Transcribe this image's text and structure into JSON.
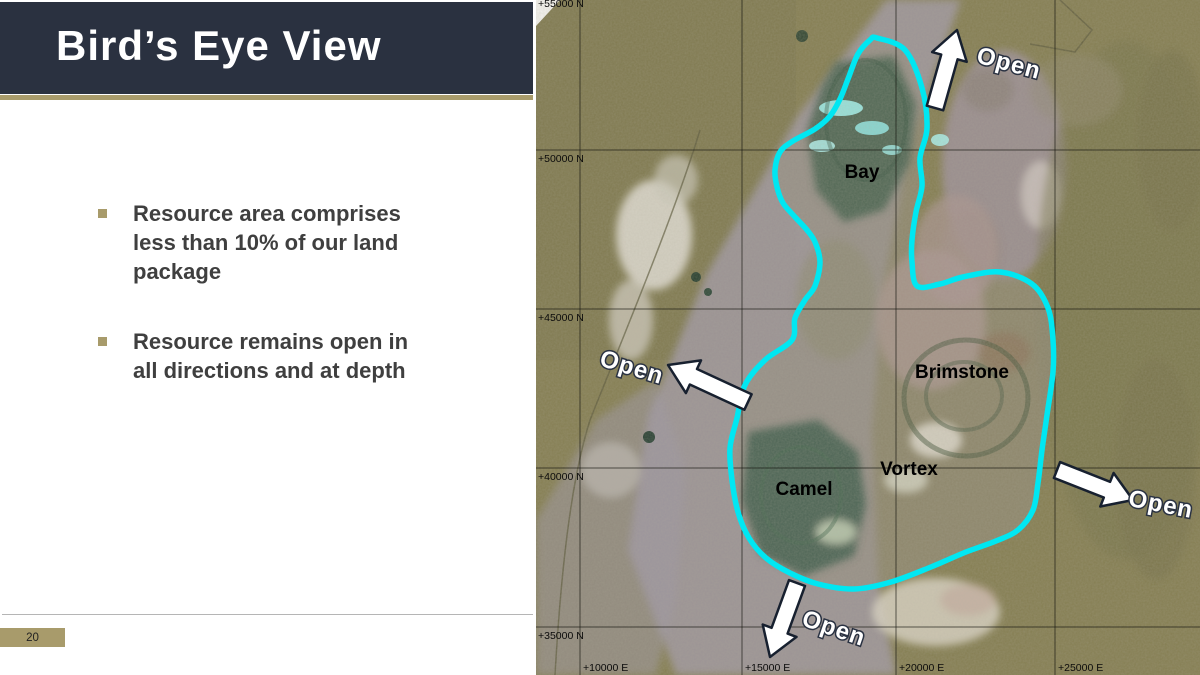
{
  "theme": {
    "navy": "#2a3140",
    "tan": "#a89b6b",
    "bodytext": "#3f3f3f",
    "cyan": "#00e7f2"
  },
  "slide": {
    "title": "Bird’s Eye View",
    "bullets": [
      "Resource area comprises\nless than 10% of our land\npackage",
      "Resource remains open in\nall directions and at depth"
    ],
    "page_number": "20"
  },
  "map": {
    "grid": {
      "vlines": [
        44,
        206,
        360,
        519
      ],
      "hlines": [
        150,
        309,
        468,
        627
      ],
      "n_labels": [
        {
          "text": "+55000 N",
          "x": 2,
          "y": 7
        },
        {
          "text": "+50000 N",
          "x": 2,
          "y": 162
        },
        {
          "text": "+45000 N",
          "x": 2,
          "y": 321
        },
        {
          "text": "+40000 N",
          "x": 2,
          "y": 480
        },
        {
          "text": "+35000 N",
          "x": 2,
          "y": 639
        }
      ],
      "e_labels": [
        {
          "text": "+10000 E",
          "x": 47,
          "y": 671
        },
        {
          "text": "+15000 E",
          "x": 209,
          "y": 671
        },
        {
          "text": "+20000 E",
          "x": 363,
          "y": 671
        },
        {
          "text": "+25000 E",
          "x": 522,
          "y": 671
        }
      ]
    },
    "area_labels": [
      {
        "text": "Bay",
        "x": 326,
        "y": 171
      },
      {
        "text": "Brimstone",
        "x": 426,
        "y": 371
      },
      {
        "text": "Vortex",
        "x": 373,
        "y": 468
      },
      {
        "text": "Camel",
        "x": 268,
        "y": 488
      }
    ],
    "arrows": [
      {
        "label": "Open",
        "tail": [
          399,
          108
        ],
        "tip": [
          421,
          30
        ],
        "label_pos": [
          473,
          63
        ],
        "label_rot": 15
      },
      {
        "label": "Open",
        "tail": [
          212,
          402
        ],
        "tip": [
          132,
          365
        ],
        "label_pos": [
          96,
          367
        ],
        "label_rot": 17
      },
      {
        "label": "Open",
        "tail": [
          521,
          470
        ],
        "tip": [
          597,
          500
        ],
        "label_pos": [
          625,
          504
        ],
        "label_rot": 11
      },
      {
        "label": "Open",
        "tail": [
          261,
          583
        ],
        "tip": [
          234,
          657
        ],
        "label_pos": [
          298,
          628
        ],
        "label_rot": 19
      }
    ],
    "outline_points": [
      [
        341,
        38
      ],
      [
        369,
        50
      ],
      [
        386,
        88
      ],
      [
        391,
        128
      ],
      [
        384,
        158
      ],
      [
        386,
        186
      ],
      [
        380,
        212
      ],
      [
        376,
        240
      ],
      [
        376,
        262
      ],
      [
        381,
        286
      ],
      [
        404,
        284
      ],
      [
        427,
        277
      ],
      [
        464,
        272
      ],
      [
        496,
        284
      ],
      [
        512,
        308
      ],
      [
        517,
        340
      ],
      [
        517,
        372
      ],
      [
        511,
        415
      ],
      [
        506,
        450
      ],
      [
        502,
        483
      ],
      [
        497,
        510
      ],
      [
        482,
        530
      ],
      [
        460,
        541
      ],
      [
        430,
        552
      ],
      [
        395,
        567
      ],
      [
        355,
        582
      ],
      [
        318,
        589
      ],
      [
        282,
        584
      ],
      [
        254,
        573
      ],
      [
        230,
        558
      ],
      [
        213,
        538
      ],
      [
        202,
        512
      ],
      [
        196,
        480
      ],
      [
        194,
        448
      ],
      [
        201,
        418
      ],
      [
        209,
        385
      ],
      [
        229,
        360
      ],
      [
        256,
        340
      ],
      [
        259,
        318
      ],
      [
        269,
        300
      ],
      [
        279,
        286
      ],
      [
        284,
        262
      ],
      [
        279,
        242
      ],
      [
        271,
        230
      ],
      [
        259,
        217
      ],
      [
        247,
        203
      ],
      [
        241,
        187
      ],
      [
        239,
        170
      ],
      [
        244,
        152
      ],
      [
        257,
        141
      ],
      [
        279,
        129
      ],
      [
        294,
        116
      ],
      [
        304,
        99
      ],
      [
        312,
        79
      ],
      [
        322,
        54
      ],
      [
        334,
        40
      ]
    ]
  }
}
